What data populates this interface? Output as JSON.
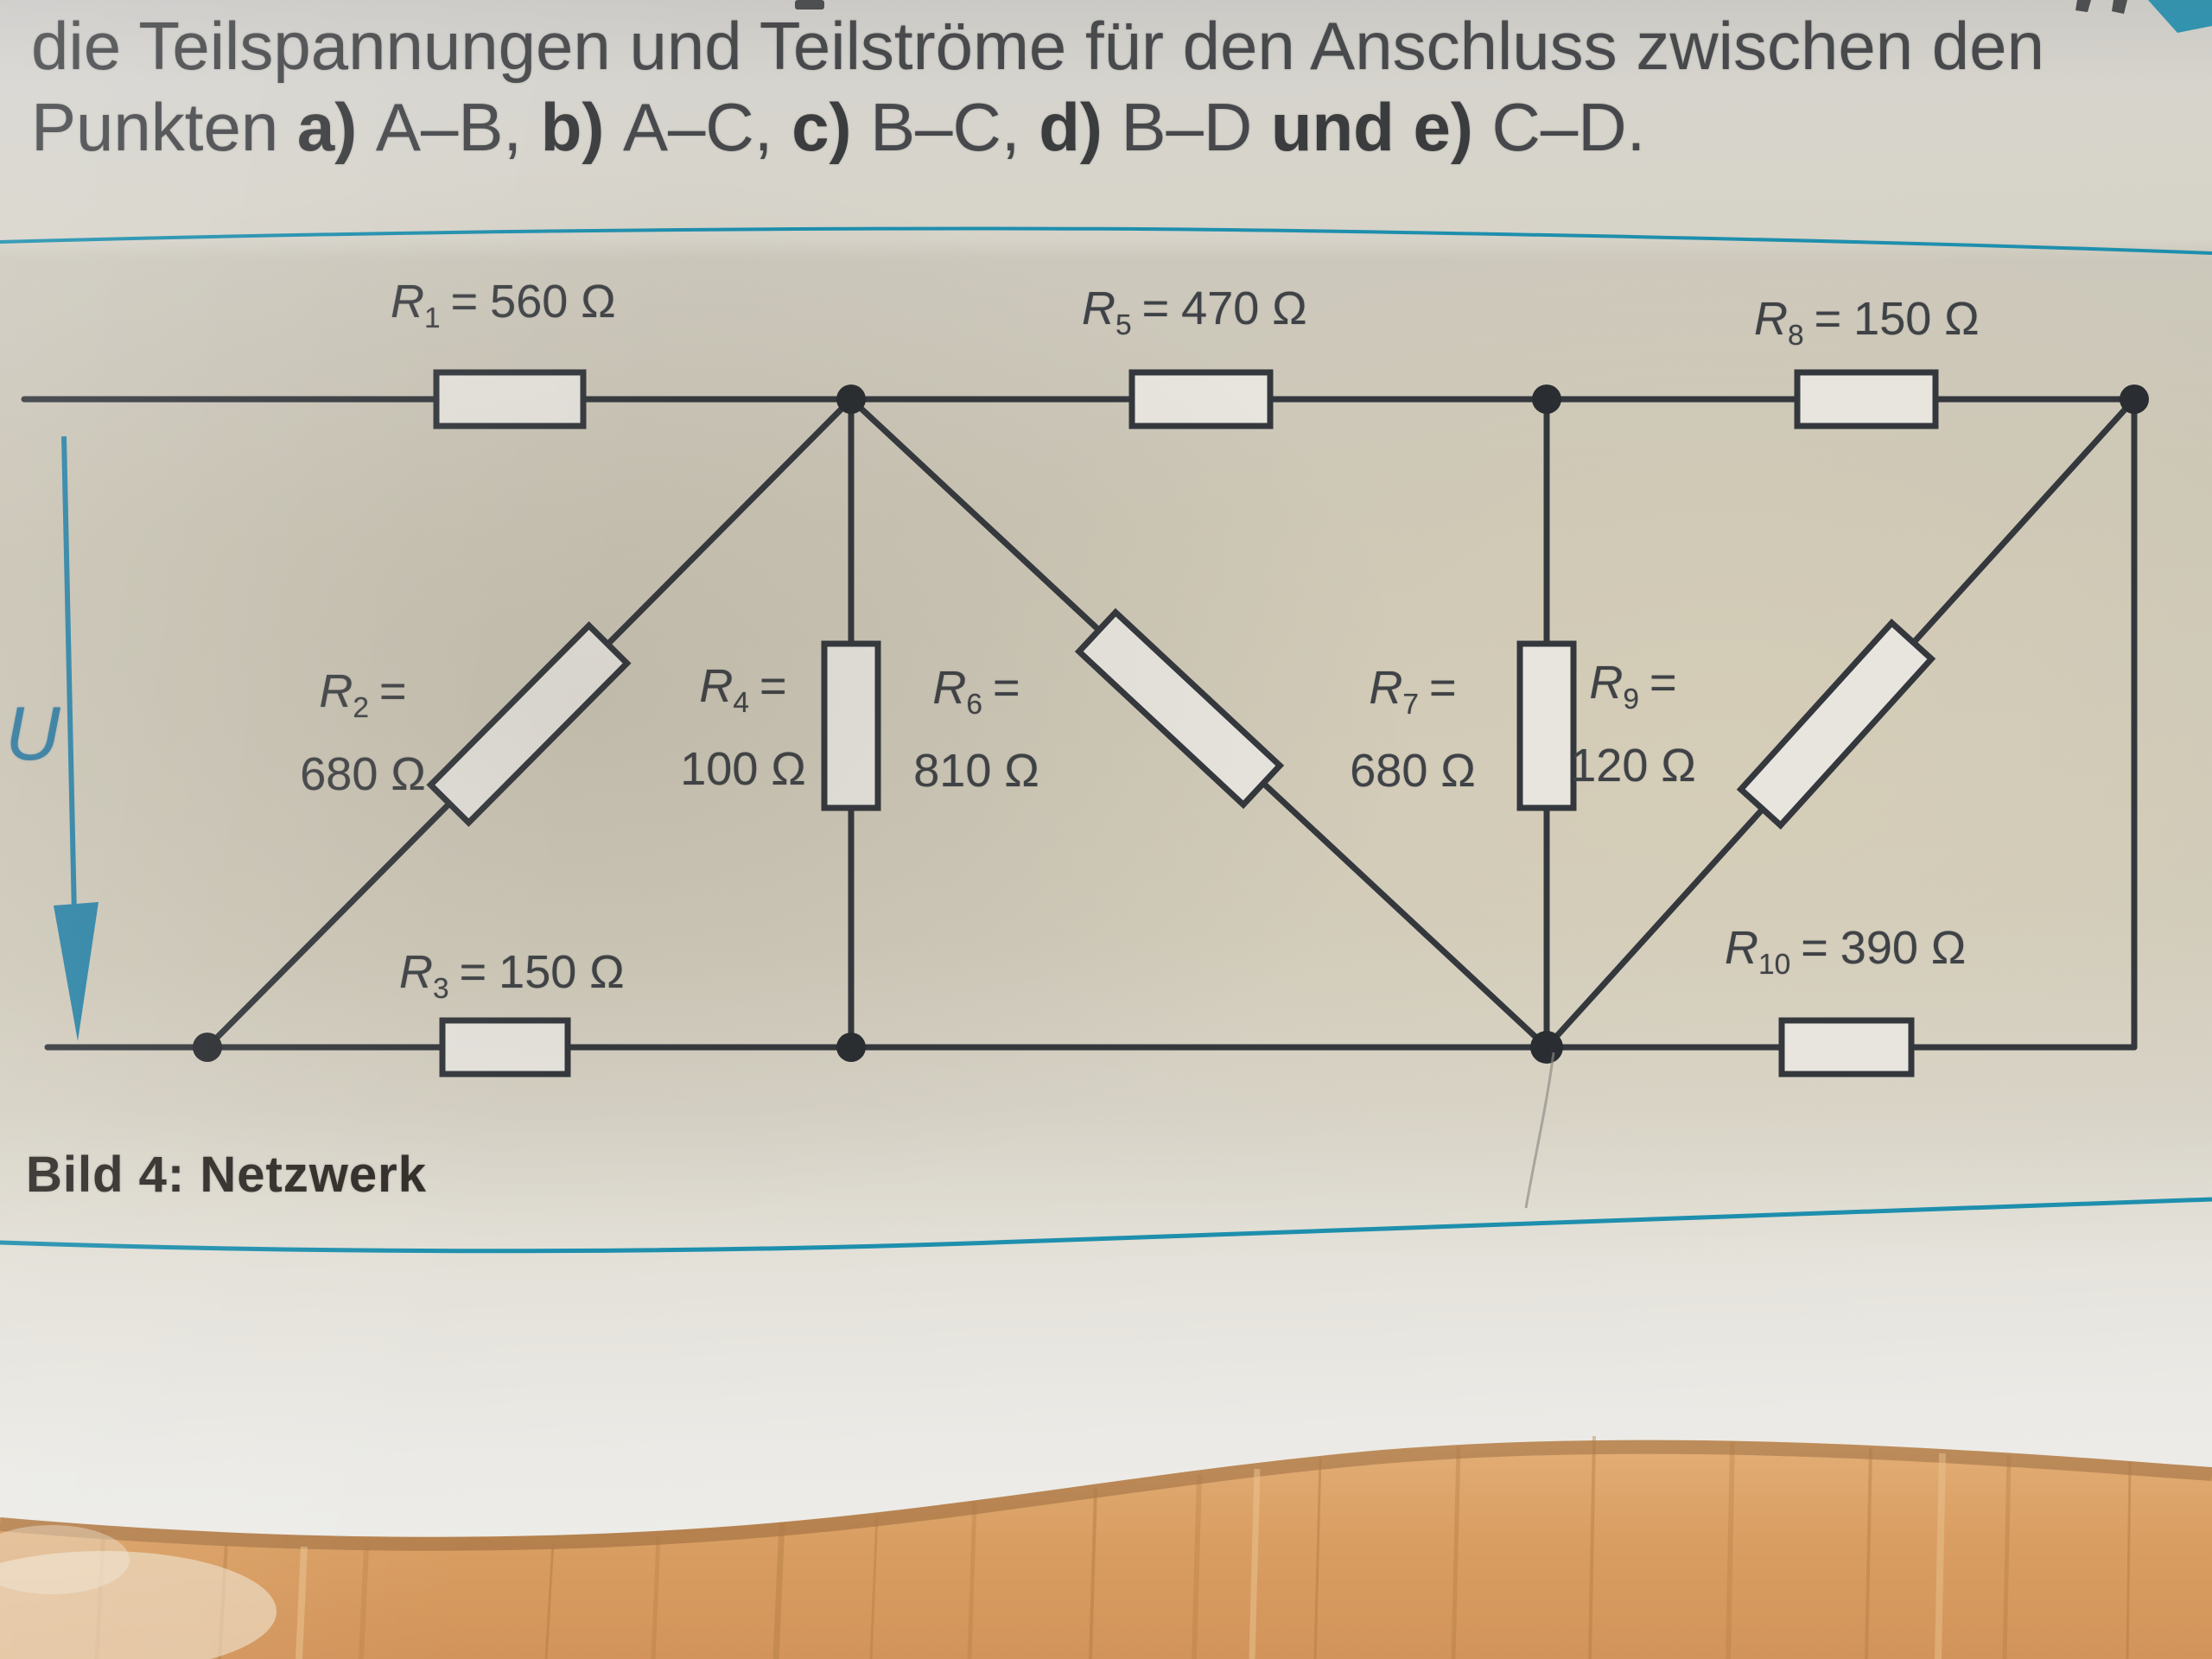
{
  "instructions": {
    "line1": "die Teilspannungen und Teilströme für den Anschluss zwischen den",
    "line2": {
      "s1": "Punkten ",
      "s2": "a) ",
      "s3": "A–B, ",
      "s4": "b) ",
      "s5": "A–C, ",
      "s6": "c) ",
      "s7": "B–C, ",
      "s8": "d) ",
      "s9": "B–D ",
      "s10": "und ",
      "s11": "e) ",
      "s12": "C–D."
    }
  },
  "figure": {
    "caption": "Bild 4: Netzwerk",
    "voltage_label": "U",
    "resistors": [
      {
        "sym": "R",
        "sub": "1",
        "eq": "=",
        "value": "560 Ω"
      },
      {
        "sym": "R",
        "sub": "2",
        "eq": "=",
        "value": "680 Ω"
      },
      {
        "sym": "R",
        "sub": "3",
        "eq": "=",
        "value": "150 Ω"
      },
      {
        "sym": "R",
        "sub": "4",
        "eq": "=",
        "value": "100 Ω"
      },
      {
        "sym": "R",
        "sub": "5",
        "eq": "=",
        "value": "470 Ω"
      },
      {
        "sym": "R",
        "sub": "6",
        "eq": "=",
        "value": "810 Ω"
      },
      {
        "sym": "R",
        "sub": "7",
        "eq": "=",
        "value": "680 Ω"
      },
      {
        "sym": "R",
        "sub": "8",
        "eq": "=",
        "value": "150 Ω"
      },
      {
        "sym": "R",
        "sub": "9",
        "eq": "=",
        "value": "120 Ω"
      },
      {
        "sym": "R",
        "sub": "10",
        "eq": "=",
        "value": "390 Ω"
      }
    ],
    "colors": {
      "rule_teal": "#1e8fad",
      "wire": "#34383d",
      "arrow_blue": "#2b84a8",
      "resistor_fill": "#e8e5df",
      "wood": "#d89c5f"
    }
  }
}
